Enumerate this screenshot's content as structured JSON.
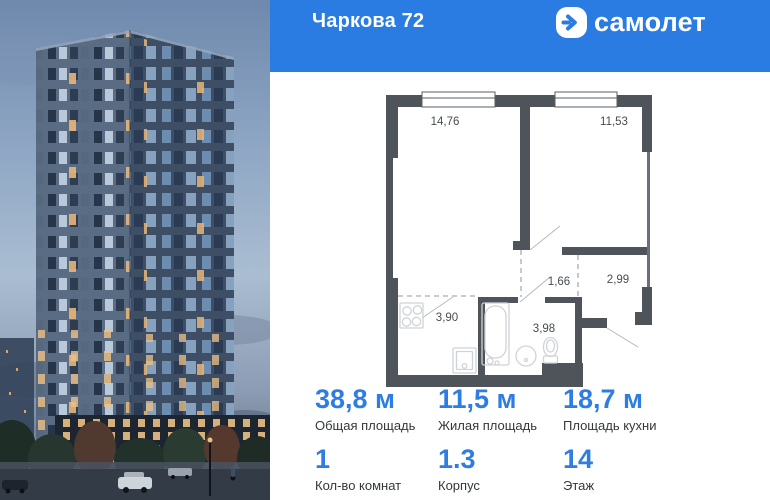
{
  "header": {
    "title": "Чаркова 72",
    "brand": "самолет",
    "brand_icon": "arrow-right-circle-icon",
    "bg_color": "#2b7ce2"
  },
  "plan": {
    "rooms": [
      {
        "name": "living-room",
        "area": "14,76"
      },
      {
        "name": "bedroom",
        "area": "11,53"
      },
      {
        "name": "hall",
        "area": "1,66"
      },
      {
        "name": "corridor",
        "area": "2,99"
      },
      {
        "name": "kitchen",
        "area": "3,90"
      },
      {
        "name": "bathroom",
        "area": "3,98"
      }
    ]
  },
  "stats": {
    "items": [
      {
        "value": "38,8 м",
        "label": "Общая площадь"
      },
      {
        "value": "11,5 м",
        "label": "Жилая площадь"
      },
      {
        "value": "18,7 м",
        "label": "Площадь кухни"
      },
      {
        "value": "1",
        "label": "Кол-во комнат"
      },
      {
        "value": "1.3",
        "label": "Корпус"
      },
      {
        "value": "14",
        "label": "Этаж"
      }
    ]
  },
  "colors": {
    "accent": "#2b7ce2",
    "stat_value": "#2e7de2",
    "wall": "#4f545a",
    "plan_label": "#474c52",
    "dashed_line": "#a8adb3"
  }
}
